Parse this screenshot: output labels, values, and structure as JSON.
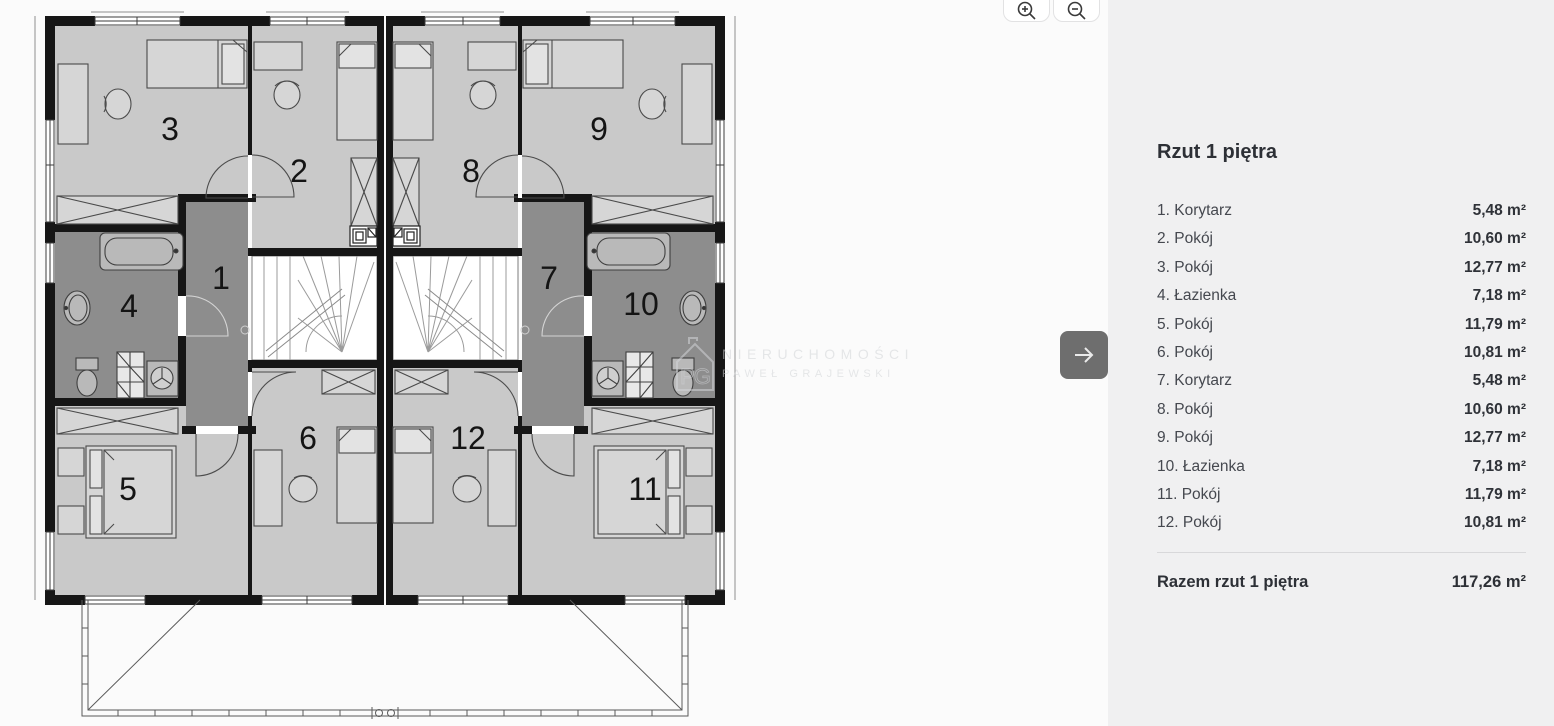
{
  "panel": {
    "title": "Rzut 1 piętra",
    "rooms": [
      {
        "num": "1",
        "name": "Korytarz",
        "area": "5,48 m²"
      },
      {
        "num": "2",
        "name": "Pokój",
        "area": "10,60 m²"
      },
      {
        "num": "3",
        "name": "Pokój",
        "area": "12,77 m²"
      },
      {
        "num": "4",
        "name": "Łazienka",
        "area": "7,18 m²"
      },
      {
        "num": "5",
        "name": "Pokój",
        "area": "11,79 m²"
      },
      {
        "num": "6",
        "name": "Pokój",
        "area": "10,81 m²"
      },
      {
        "num": "7",
        "name": "Korytarz",
        "area": "5,48 m²"
      },
      {
        "num": "8",
        "name": "Pokój",
        "area": "10,60 m²"
      },
      {
        "num": "9",
        "name": "Pokój",
        "area": "12,77 m²"
      },
      {
        "num": "10",
        "name": "Łazienka",
        "area": "7,18 m²"
      },
      {
        "num": "11",
        "name": "Pokój",
        "area": "11,79 m²"
      },
      {
        "num": "12",
        "name": "Pokój",
        "area": "10,81 m²"
      }
    ],
    "total_label": "Razem rzut 1 piętra",
    "total_value": "117,26 m²"
  },
  "watermark": {
    "line1": "NIERUCHOMOŚCI",
    "line2": "PAWEŁ GRAJEWSKI",
    "monogram": "PG"
  },
  "icons": {
    "zoom_in": "magnifier-plus-icon",
    "zoom_out": "magnifier-minus-icon",
    "next": "arrow-right-icon"
  },
  "colors": {
    "panel_bg": "#f0f0f1",
    "canvas_bg": "#fbfbfb",
    "wall": "#161616",
    "room_light": "#c9c9c9",
    "room_dark": "#8d8d8d",
    "button_dark": "#6e6e6e",
    "text_dark": "#2d3036",
    "text_row": "#45484f"
  }
}
